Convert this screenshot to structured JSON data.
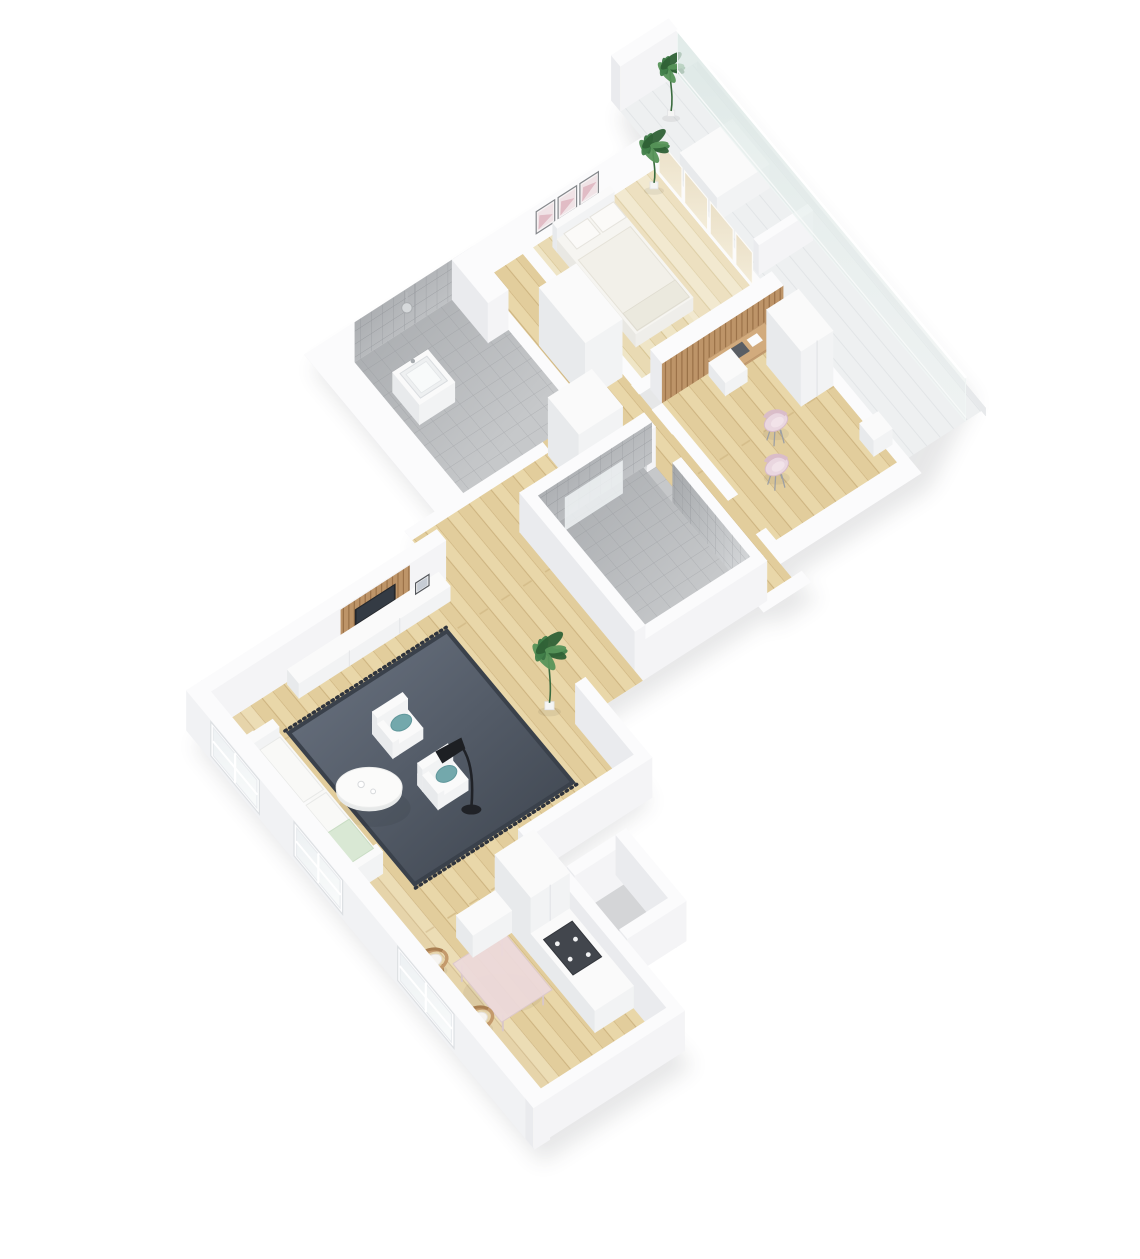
{
  "scene": {
    "title": "3D isometric apartment floor plan render",
    "background": "#ffffff",
    "projection": "dimetric bird's-eye"
  },
  "colors": {
    "background": "#ffffff",
    "wallTop": "#fbfbfc",
    "wallSide": "#eaebee",
    "wallFace": "#f4f4f6",
    "furnTop": "#fafafa",
    "furnSide": "#f2f3f4",
    "furnShade": "#e8eaec",
    "woodFloor": "#e9d7a9",
    "woodFloorPale": "#efe5c6",
    "tileFloor": "#c6c8ca",
    "tileWallDark": "#95989c",
    "tileWallLight": "#d8dadc",
    "balconyFloor": "#eef0f1",
    "glass": "#d9e6e3",
    "rugLight": "#6b7482",
    "rugDark": "#3c434d",
    "teal": "#73a8ac",
    "tealDark": "#5f979b",
    "mint": "#d9e8d4",
    "pink": "#ead7e0",
    "pinkDark": "#d9bcc9",
    "rattan": "#c49a6c",
    "rattanDark": "#a97f52",
    "woodAccent": "#bd9468",
    "deskWood": "#d2ab7d",
    "diningTop": "#ecd9da",
    "lamp": "#202227",
    "tv": "#24272c",
    "cooktop": "#42464d",
    "nicheGray": "#d4d5d7",
    "plantGreen": "#41804a",
    "artPink": "#dfb7c1"
  },
  "rooms": [
    {
      "name": "bedroom",
      "floor": "pale-wood",
      "items": [
        "double-bed",
        "wall-art-triptych",
        "glazed-window-wall",
        "potted-plant"
      ]
    },
    {
      "name": "home-office",
      "floor": "wood",
      "items": [
        "wood-slat-desk-wall",
        "desk",
        "drawer-unit",
        "wardrobe-cabinet",
        "pink-chair",
        "pink-chair",
        "side-table"
      ]
    },
    {
      "name": "bathroom",
      "floor": "gray-tile",
      "items": [
        "shower-head",
        "washbasin",
        "partition-wall"
      ]
    },
    {
      "name": "shower-room",
      "floor": "gray-tile",
      "items": [
        "glass-screen",
        "floor-drain"
      ]
    },
    {
      "name": "hallway",
      "floor": "wood",
      "items": [
        "wardrobe",
        "tall-cabinet"
      ]
    },
    {
      "name": "living-room-kitchen",
      "floor": "wood",
      "items": [
        "sofa",
        "armchair",
        "armchair",
        "area-rug",
        "round-coffee-table",
        "arc-floor-lamp",
        "tv-sideboard",
        "wood-slat-tv-panel",
        "tv",
        "potted-plant",
        "dining-table",
        "rattan-chair",
        "rattan-chair",
        "kitchen-counter",
        "cooktop",
        "fridge-cabinet",
        "facade-window",
        "facade-window",
        "facade-window"
      ]
    },
    {
      "name": "balcony",
      "floor": "deck",
      "items": [
        "glass-balustrade",
        "potted-plant",
        "bench"
      ]
    },
    {
      "name": "entry-niche",
      "floor": "gray"
    }
  ]
}
